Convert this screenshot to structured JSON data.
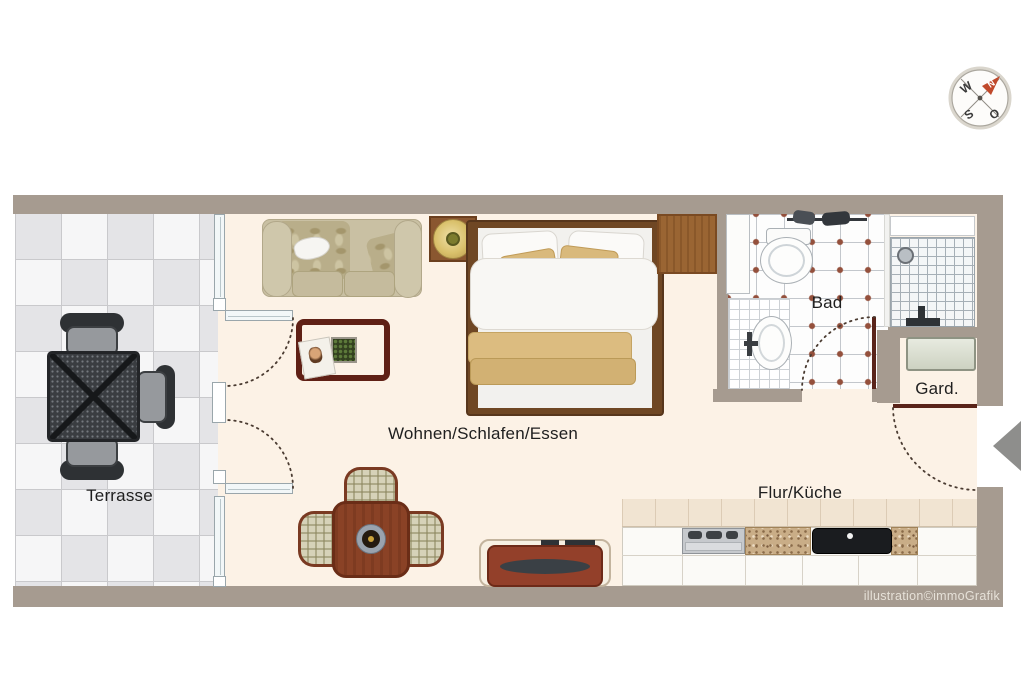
{
  "credit": "illustration©immoGrafik",
  "compass": {
    "n": "N",
    "w": "W",
    "s": "S",
    "o": "O"
  },
  "rooms": {
    "terrace": "Terrasse",
    "living": "Wohnen/Schlafen/Essen",
    "bath": "Bad",
    "wardrobe": "Gard.",
    "hall_kitchen": "Flur/Küche"
  },
  "colors": {
    "wall": "#a69b90",
    "floor": "#fcf2e6",
    "door_leaf": "#5a241a",
    "tile_dot": "#94503c",
    "compass_arrow": "#c0492b",
    "entrance_marker": "#8e8e8c"
  }
}
